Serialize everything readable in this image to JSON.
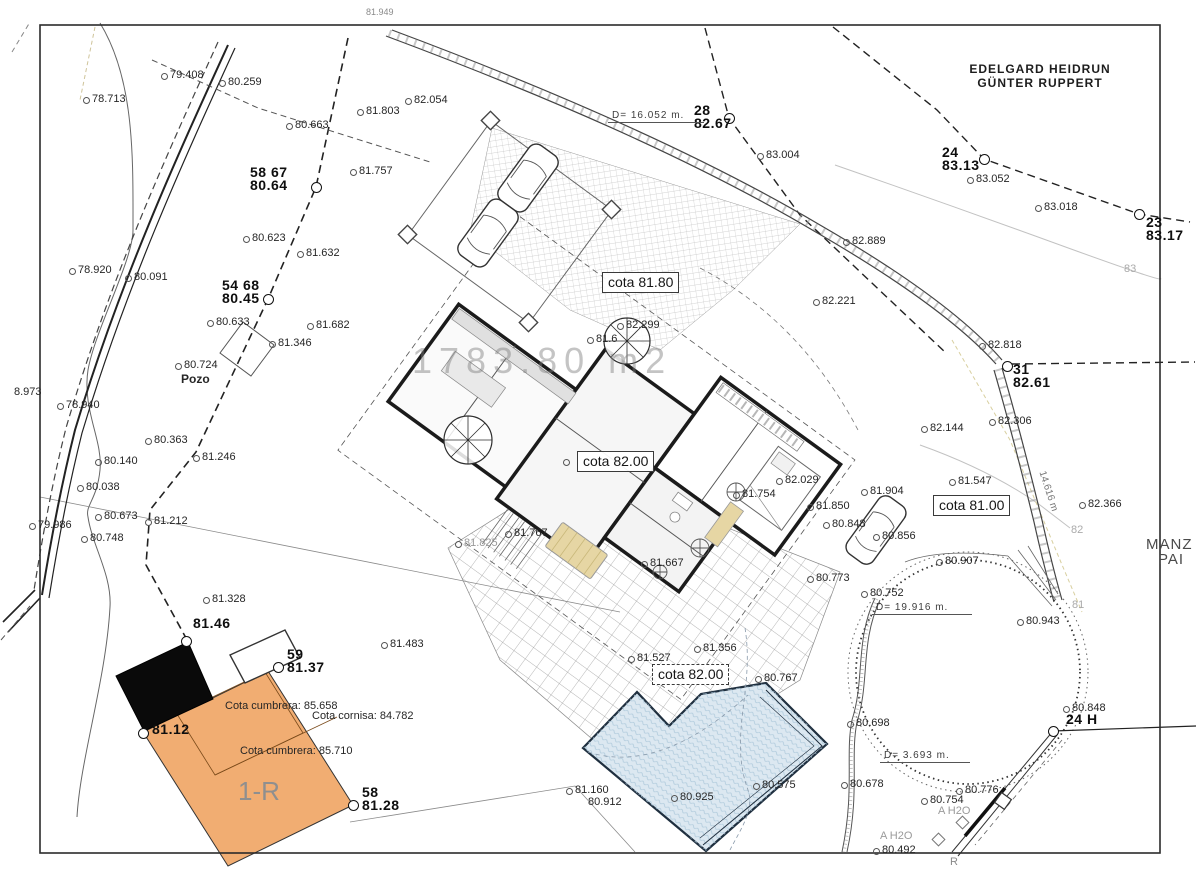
{
  "watermark": "1783.80 m2",
  "owner": {
    "line1": "EDELGARD HEIDRUN",
    "line2": "GÜNTER RUPPERT"
  },
  "edge": {
    "right_top": "MANZ",
    "right_bottom": "PAI"
  },
  "colors": {
    "paper": "#ffffff",
    "ink": "#1b1b1b",
    "building_fill": "#f1ad72",
    "existing_black": "#0a0a0a",
    "pool_fill": "#dce8f1",
    "pool_edge": "#1f2f3f",
    "hatch_gray": "#b8b8b8",
    "watermark_gray": "#7d7d7d"
  },
  "cotas": [
    {
      "t": "cota 81.80",
      "x": 602,
      "y": 272,
      "dashed": false,
      "dot": false
    },
    {
      "t": "cota 82.00",
      "x": 577,
      "y": 451,
      "dashed": false,
      "dot": true
    },
    {
      "t": "cota 81.00",
      "x": 933,
      "y": 495,
      "dashed": false,
      "dot": false
    },
    {
      "t": "cota 82.00",
      "x": 652,
      "y": 664,
      "dashed": true,
      "dot": false
    }
  ],
  "measures": [
    {
      "t": "D= 16.052 m.",
      "x": 608,
      "y": 110,
      "w": 88
    },
    {
      "t": "D= 19.916 m.",
      "x": 872,
      "y": 602,
      "w": 92
    },
    {
      "t": "D= 3.693 m.",
      "x": 880,
      "y": 750,
      "w": 82
    }
  ],
  "stations": [
    {
      "l1": "58 67",
      "l2": "80.64",
      "tx": 250,
      "ty": 166,
      "mx": 316,
      "my": 187
    },
    {
      "l1": "54 68",
      "l2": "80.45",
      "tx": 222,
      "ty": 279,
      "mx": 268,
      "my": 299
    },
    {
      "l1": "28",
      "l2": "82.67",
      "tx": 694,
      "ty": 104,
      "mx": 729,
      "my": 118
    },
    {
      "l1": "24",
      "l2": "83.13",
      "tx": 942,
      "ty": 146,
      "mx": 984,
      "my": 159
    },
    {
      "l1": "23",
      "l2": "83.17",
      "tx": 1146,
      "ty": 216,
      "mx": 1139,
      "my": 214
    },
    {
      "l1": "31",
      "l2": "82.61",
      "tx": 1013,
      "ty": 363,
      "mx": 1007,
      "my": 366
    },
    {
      "l1": "59",
      "l2": "81.37",
      "tx": 287,
      "ty": 648,
      "mx": 278,
      "my": 667
    },
    {
      "l1": "58",
      "l2": "81.28",
      "tx": 362,
      "ty": 786,
      "mx": 353,
      "my": 805
    },
    {
      "l1": "81.46",
      "l2": "",
      "tx": 193,
      "ty": 617,
      "mx": 186,
      "my": 641
    },
    {
      "l1": "81.12",
      "l2": "",
      "tx": 152,
      "ty": 723,
      "mx": 143,
      "my": 733
    },
    {
      "l1": "24 H",
      "l2": "",
      "tx": 1066,
      "ty": 713,
      "mx": 1053,
      "my": 731
    }
  ],
  "labels": [
    {
      "t": "78.713",
      "x": 92,
      "y": 94
    },
    {
      "t": "79.408",
      "x": 170,
      "y": 70
    },
    {
      "t": "80.259",
      "x": 228,
      "y": 77
    },
    {
      "t": "80.663",
      "x": 295,
      "y": 120
    },
    {
      "t": "81.803",
      "x": 366,
      "y": 106
    },
    {
      "t": "82.054",
      "x": 414,
      "y": 95
    },
    {
      "t": "81.757",
      "x": 359,
      "y": 166
    },
    {
      "t": "80.623",
      "x": 252,
      "y": 233
    },
    {
      "t": "81.632",
      "x": 306,
      "y": 248
    },
    {
      "t": "78.920",
      "x": 78,
      "y": 265
    },
    {
      "t": "80.091",
      "x": 134,
      "y": 272
    },
    {
      "t": "80.633",
      "x": 216,
      "y": 317
    },
    {
      "t": "81.682",
      "x": 316,
      "y": 320
    },
    {
      "t": "81.346",
      "x": 278,
      "y": 338
    },
    {
      "t": "80.724",
      "x": 184,
      "y": 360
    },
    {
      "t": "Pozo",
      "x": 181,
      "y": 373,
      "b": true,
      "size": 12,
      "dot": false,
      "name": "well-label"
    },
    {
      "t": "8.973",
      "x": 14,
      "y": 387,
      "dot": false
    },
    {
      "t": "78.940",
      "x": 66,
      "y": 400
    },
    {
      "t": "80.363",
      "x": 154,
      "y": 435
    },
    {
      "t": "81.246",
      "x": 202,
      "y": 452
    },
    {
      "t": "80.140",
      "x": 104,
      "y": 456
    },
    {
      "t": "80.038",
      "x": 86,
      "y": 482
    },
    {
      "t": "80.673",
      "x": 104,
      "y": 511
    },
    {
      "t": "81.212",
      "x": 154,
      "y": 516
    },
    {
      "t": "79.986",
      "x": 38,
      "y": 520
    },
    {
      "t": "80.748",
      "x": 90,
      "y": 533
    },
    {
      "t": "82.299",
      "x": 626,
      "y": 320
    },
    {
      "t": "81.6",
      "x": 596,
      "y": 334
    },
    {
      "t": "82.221",
      "x": 822,
      "y": 296
    },
    {
      "t": "82.889",
      "x": 852,
      "y": 236
    },
    {
      "t": "83.004",
      "x": 766,
      "y": 150
    },
    {
      "t": "83.052",
      "x": 976,
      "y": 174
    },
    {
      "t": "83.018",
      "x": 1044,
      "y": 202
    },
    {
      "t": "82.818",
      "x": 988,
      "y": 340
    },
    {
      "t": "82.306",
      "x": 998,
      "y": 416
    },
    {
      "t": "82.144",
      "x": 930,
      "y": 423
    },
    {
      "t": "82.366",
      "x": 1088,
      "y": 499
    },
    {
      "t": "81.547",
      "x": 958,
      "y": 476
    },
    {
      "t": "81.904",
      "x": 870,
      "y": 486
    },
    {
      "t": "82.029",
      "x": 785,
      "y": 475
    },
    {
      "t": "81.754",
      "x": 742,
      "y": 489
    },
    {
      "t": "81.850",
      "x": 816,
      "y": 501
    },
    {
      "t": "80.848",
      "x": 832,
      "y": 519
    },
    {
      "t": "80.856",
      "x": 882,
      "y": 531
    },
    {
      "t": "81.767",
      "x": 514,
      "y": 528
    },
    {
      "t": "81.825",
      "x": 464,
      "y": 538,
      "color": "#9a9a9a"
    },
    {
      "t": "81.667",
      "x": 650,
      "y": 558
    },
    {
      "t": "80.773",
      "x": 816,
      "y": 573
    },
    {
      "t": "80.752",
      "x": 870,
      "y": 588
    },
    {
      "t": "80.907",
      "x": 945,
      "y": 556
    },
    {
      "t": "80.943",
      "x": 1026,
      "y": 616
    },
    {
      "t": "81.328",
      "x": 212,
      "y": 594
    },
    {
      "t": "81.483",
      "x": 390,
      "y": 639
    },
    {
      "t": "81.527",
      "x": 637,
      "y": 653
    },
    {
      "t": "81.356",
      "x": 703,
      "y": 643
    },
    {
      "t": "80.767",
      "x": 764,
      "y": 673
    },
    {
      "t": "81.160",
      "x": 575,
      "y": 785
    },
    {
      "t": "80.912",
      "x": 588,
      "y": 797,
      "dot": false
    },
    {
      "t": "80.925",
      "x": 680,
      "y": 792
    },
    {
      "t": "80.575",
      "x": 762,
      "y": 780
    },
    {
      "t": "80.698",
      "x": 856,
      "y": 718
    },
    {
      "t": "80.678",
      "x": 850,
      "y": 779
    },
    {
      "t": "80.776",
      "x": 965,
      "y": 785
    },
    {
      "t": "80.754",
      "x": 930,
      "y": 795
    },
    {
      "t": "80.492",
      "x": 882,
      "y": 845
    },
    {
      "t": "80.848",
      "x": 1072,
      "y": 703
    },
    {
      "t": "83",
      "x": 1124,
      "y": 264,
      "color": "#aaaaaa",
      "dot": false,
      "name": "contour-label"
    },
    {
      "t": "82",
      "x": 1071,
      "y": 525,
      "color": "#aaaaaa",
      "dot": false,
      "name": "contour-label"
    },
    {
      "t": "81",
      "x": 1072,
      "y": 600,
      "color": "#aaaaaa",
      "dot": false,
      "name": "contour-label"
    },
    {
      "t": "A H2O",
      "x": 938,
      "y": 806,
      "color": "#9a9a9a",
      "dot": false,
      "name": "utility-label"
    },
    {
      "t": "A H2O",
      "x": 880,
      "y": 831,
      "color": "#9a9a9a",
      "dot": false,
      "name": "utility-label"
    },
    {
      "t": "R",
      "x": 950,
      "y": 857,
      "color": "#8a8a8a",
      "dot": false,
      "name": "utility-label"
    },
    {
      "t": "81.949",
      "x": 366,
      "y": 8,
      "size": 9,
      "color": "#8a8a8a",
      "dot": false
    },
    {
      "t": "14.616 m",
      "x": 1046,
      "y": 470,
      "rot": 72,
      "size": 10,
      "color": "#777777",
      "dot": false,
      "name": "wall-length-label"
    },
    {
      "t": "Cota cumbrera: 85.658",
      "x": 225,
      "y": 701,
      "dot": false,
      "name": "roof-ridge-label"
    },
    {
      "t": "Cota cornisa: 84.782",
      "x": 312,
      "y": 711,
      "dot": false,
      "name": "roof-eave-label"
    },
    {
      "t": "Cota cumbrera: 85.710",
      "x": 240,
      "y": 746,
      "dot": false,
      "name": "roof-ridge-label"
    },
    {
      "t": "1-R",
      "x": 238,
      "y": 778,
      "size": 26,
      "color": "#8f8f8f",
      "dot": false,
      "name": "building-floors-label"
    }
  ]
}
